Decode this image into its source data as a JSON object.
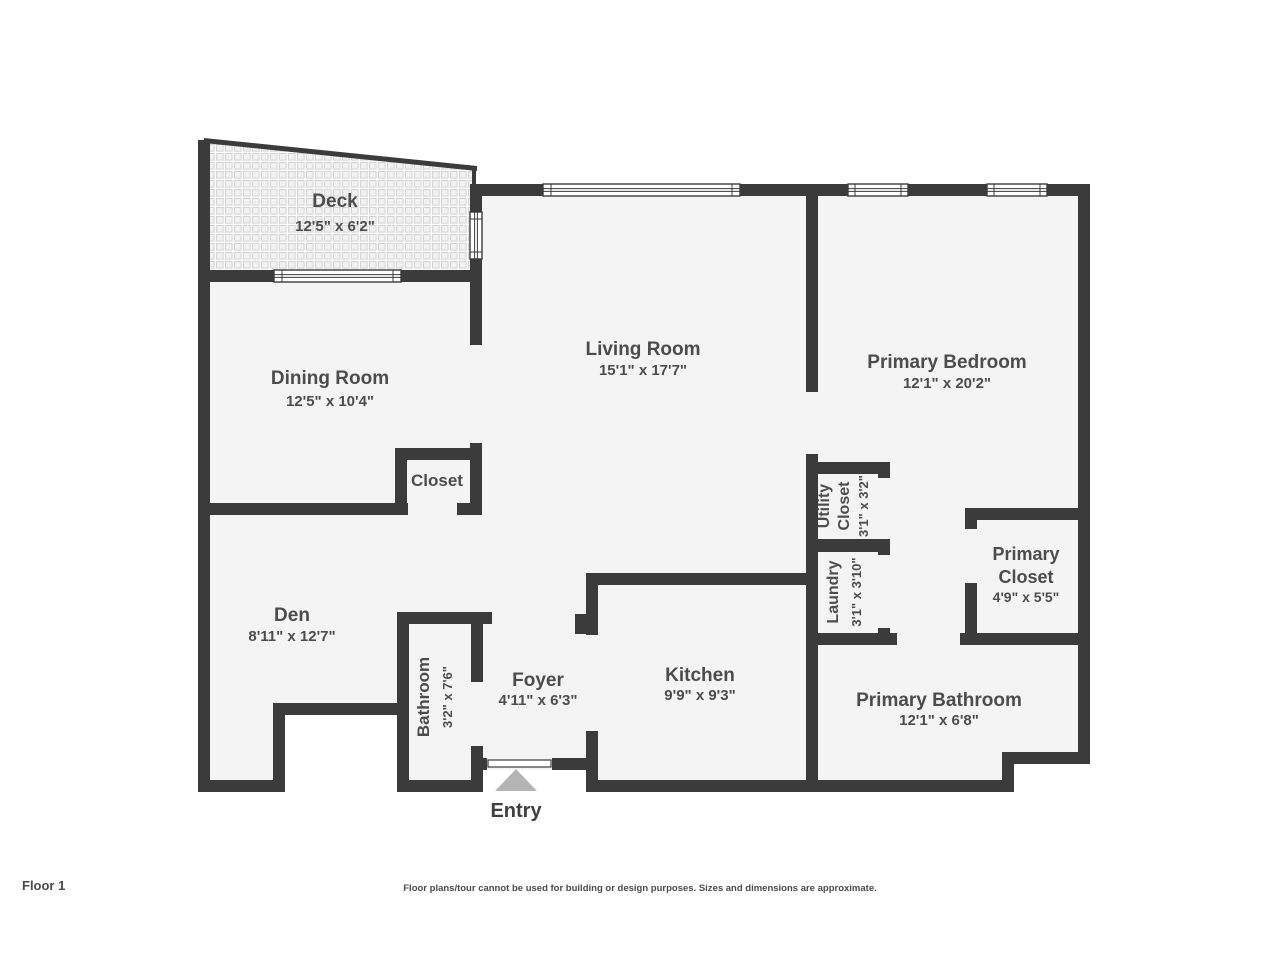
{
  "page": {
    "floor_label": "Floor 1",
    "disclaimer": "Floor plans/tour cannot be used for building or design purposes. Sizes and dimensions are approximate."
  },
  "colors": {
    "wall": "#3b3b3b",
    "floor": "#f4f4f4",
    "background": "#ffffff",
    "label_text": "#4c4c4c",
    "entry_arrow": "#b4b4b4"
  },
  "rooms": {
    "deck": {
      "name": "Deck",
      "dims": "12'5\" x 6'2\""
    },
    "dining_room": {
      "name": "Dining Room",
      "dims": "12'5\" x 10'4\""
    },
    "living_room": {
      "name": "Living Room",
      "dims": "15'1\" x 17'7\""
    },
    "primary_bedroom": {
      "name": "Primary Bedroom",
      "dims": "12'1\" x 20'2\""
    },
    "closet": {
      "name": "Closet"
    },
    "utility_closet": {
      "name_line1": "Utility",
      "name_line2": "Closet",
      "dims": "3'1\" x 3'2\""
    },
    "laundry": {
      "name": "Laundry",
      "dims": "3'1\" x 3'10\""
    },
    "primary_closet": {
      "name_line1": "Primary",
      "name_line2": "Closet",
      "dims": "4'9\" x 5'5\""
    },
    "den": {
      "name": "Den",
      "dims": "8'11\" x 12'7\""
    },
    "bathroom": {
      "name": "Bathroom",
      "dims": "3'2\" x 7'6\""
    },
    "foyer": {
      "name": "Foyer",
      "dims": "4'11\" x 6'3\""
    },
    "kitchen": {
      "name": "Kitchen",
      "dims": "9'9\" x 9'3\""
    },
    "primary_bathroom": {
      "name": "Primary Bathroom",
      "dims": "12'1\" x 6'8\""
    },
    "entry": {
      "name": "Entry"
    }
  }
}
